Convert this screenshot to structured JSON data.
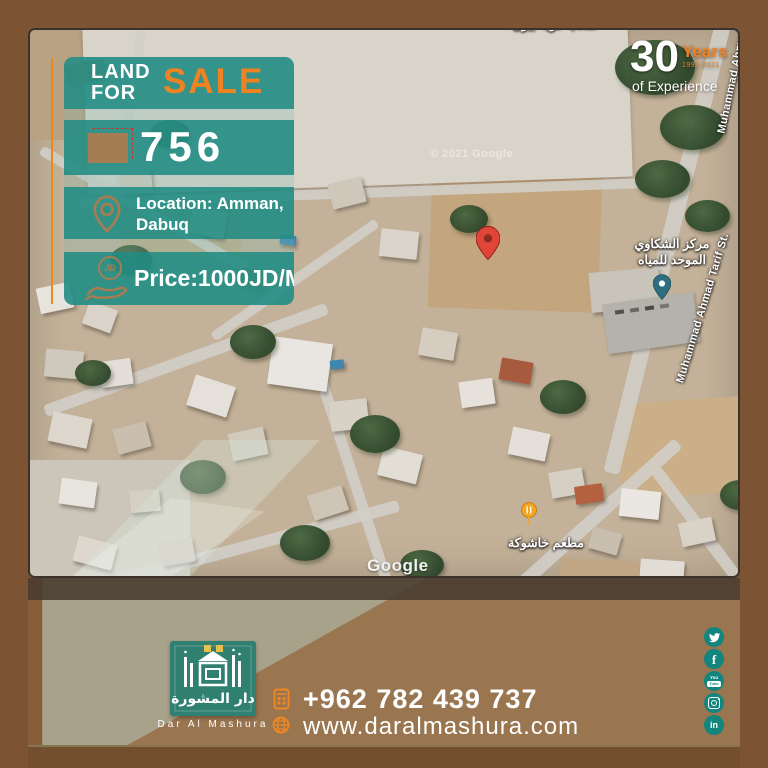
{
  "colors": {
    "frame_brown": "#7d5433",
    "teal_band": "#21928a",
    "orange_accent": "#f08222",
    "sage": "#a8a28b",
    "logo_green": "#2f8070",
    "social_teal": "#12857d",
    "pin_red": "#e04538"
  },
  "offer": {
    "land": "LAND",
    "for": "FOR",
    "sale": "SALE",
    "plot_number": "756",
    "location_line1": "Location: Amman,",
    "location_line2": "Dabuq",
    "price": "Price:1000JD/M",
    "price_icon_label": "JD"
  },
  "experience": {
    "number": "30",
    "years": "Years",
    "range": "1991-2021",
    "caption": "of Experience"
  },
  "map": {
    "street_label": "Muhammad Ahmad Tarif St.",
    "street_label_top": "Muhammad Ahmad Tarif St.",
    "poi_top_arabic": "ملعب قرية بيون",
    "poi_water_center_line1": "مركز الشكاوي",
    "poi_water_center_line2": "الموحد للمياه",
    "poi_restaurant": "مطعم خاشوكة",
    "watermark": "Google",
    "copyright": "© 2021 Google"
  },
  "footer": {
    "brand": "Dar Al Mashura",
    "brand_arabic": "دار المشورة",
    "phone": "+962 782 439 737",
    "website": "www.daralmashura.com"
  },
  "social_glyphs": {
    "facebook": "f",
    "linkedin": "in",
    "youtube_top": "You",
    "youtube_box": "Tube"
  }
}
